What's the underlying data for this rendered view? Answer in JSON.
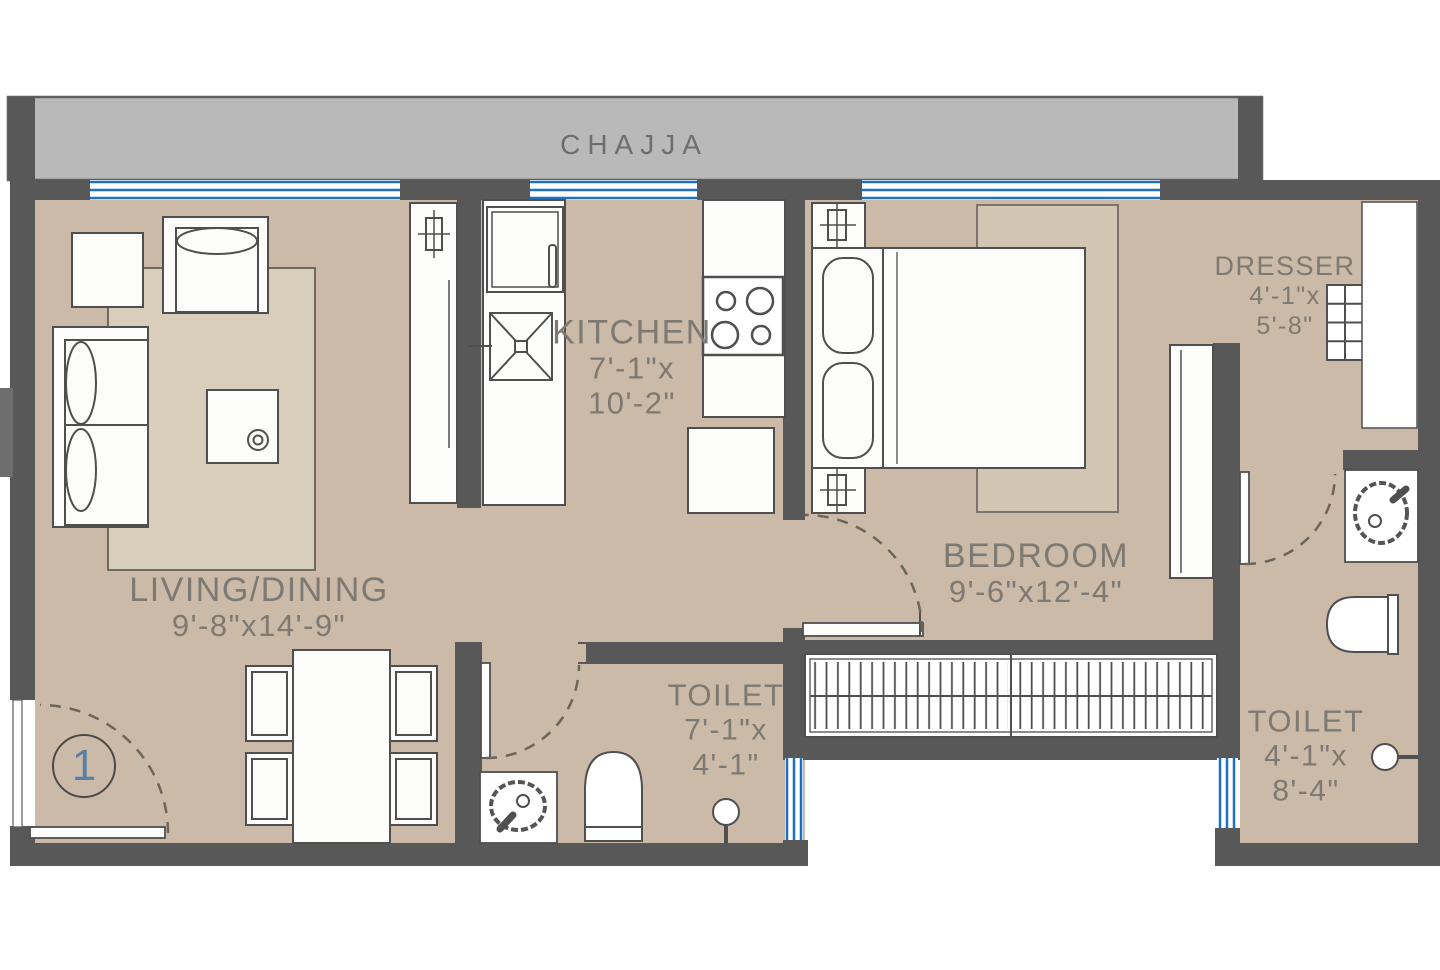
{
  "chajja": {
    "label": "CHAJJA"
  },
  "rooms": {
    "living": {
      "name": "LIVING/DINING",
      "dims": "9'-8\"x14'-9\""
    },
    "kitchen": {
      "name": "KITCHEN",
      "dim_line1": "7'-1\"x",
      "dim_line2": "10'-2\""
    },
    "bedroom": {
      "name": "BEDROOM",
      "dims": "9'-6\"x12'-4\""
    },
    "toilet_mid": {
      "name": "TOILET",
      "dim_line1": "7'-1\"x",
      "dim_line2": "4'-1\""
    },
    "toilet_right": {
      "name": "TOILET",
      "dim_line1": "4'-1\"x",
      "dim_line2": "8'-4\""
    },
    "dresser": {
      "name": "DRESSER",
      "dim_line1": "4'-1\"x",
      "dim_line2": "5'-8\""
    }
  },
  "unit_marker": "1",
  "colors": {
    "floor": "#cbbaa8",
    "wall": "#585858",
    "chajja_fill": "#b9b9b9",
    "window_blue": "#1e6fc8",
    "rug_living": "#d9cdbc",
    "rug_bedroom": "#d2c5b2",
    "label_text": "#7d7973",
    "marker_number": "#5c7fa3"
  },
  "fixtures": [
    "sofa",
    "armchair",
    "side-table",
    "coffee-table",
    "dining-table",
    "dining-chairs",
    "foyer-cabinet",
    "refrigerator",
    "kitchen-sink",
    "hob",
    "washing-machine",
    "double-bed",
    "bedside-table",
    "sliding-wardrobe",
    "hanging-wardrobe",
    "dresser-shelves",
    "duct",
    "wash-basin",
    "wc",
    "shower",
    "door-swing",
    "window"
  ]
}
